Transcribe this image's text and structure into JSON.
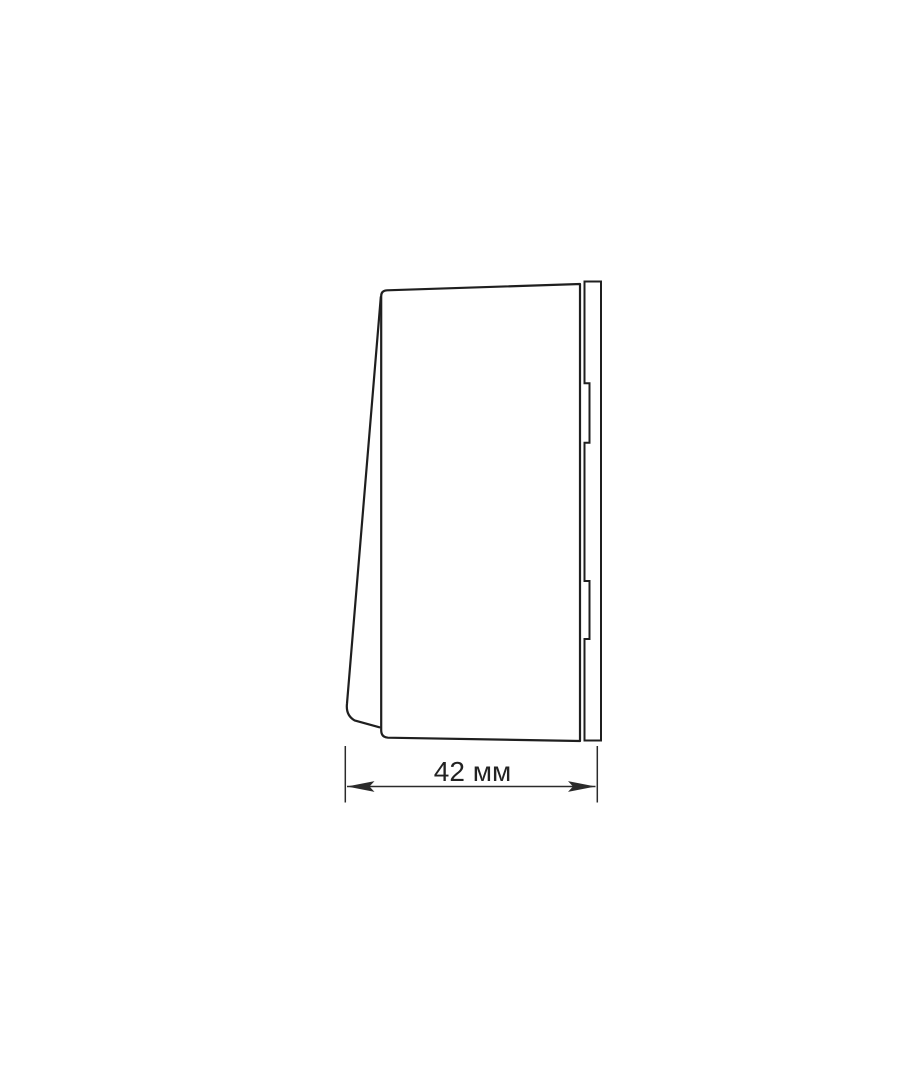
{
  "page": {
    "background": "#ffffff"
  },
  "drawing": {
    "type": "technical-line-drawing",
    "subject": "switch-side-profile-view",
    "dimension": {
      "label": "42 мм",
      "value": 42,
      "unit": "мм"
    },
    "colors": {
      "line": "#1f1f1f",
      "dimension_line": "#2b2b2b",
      "text": "#222222",
      "background": "#ffffff"
    }
  }
}
